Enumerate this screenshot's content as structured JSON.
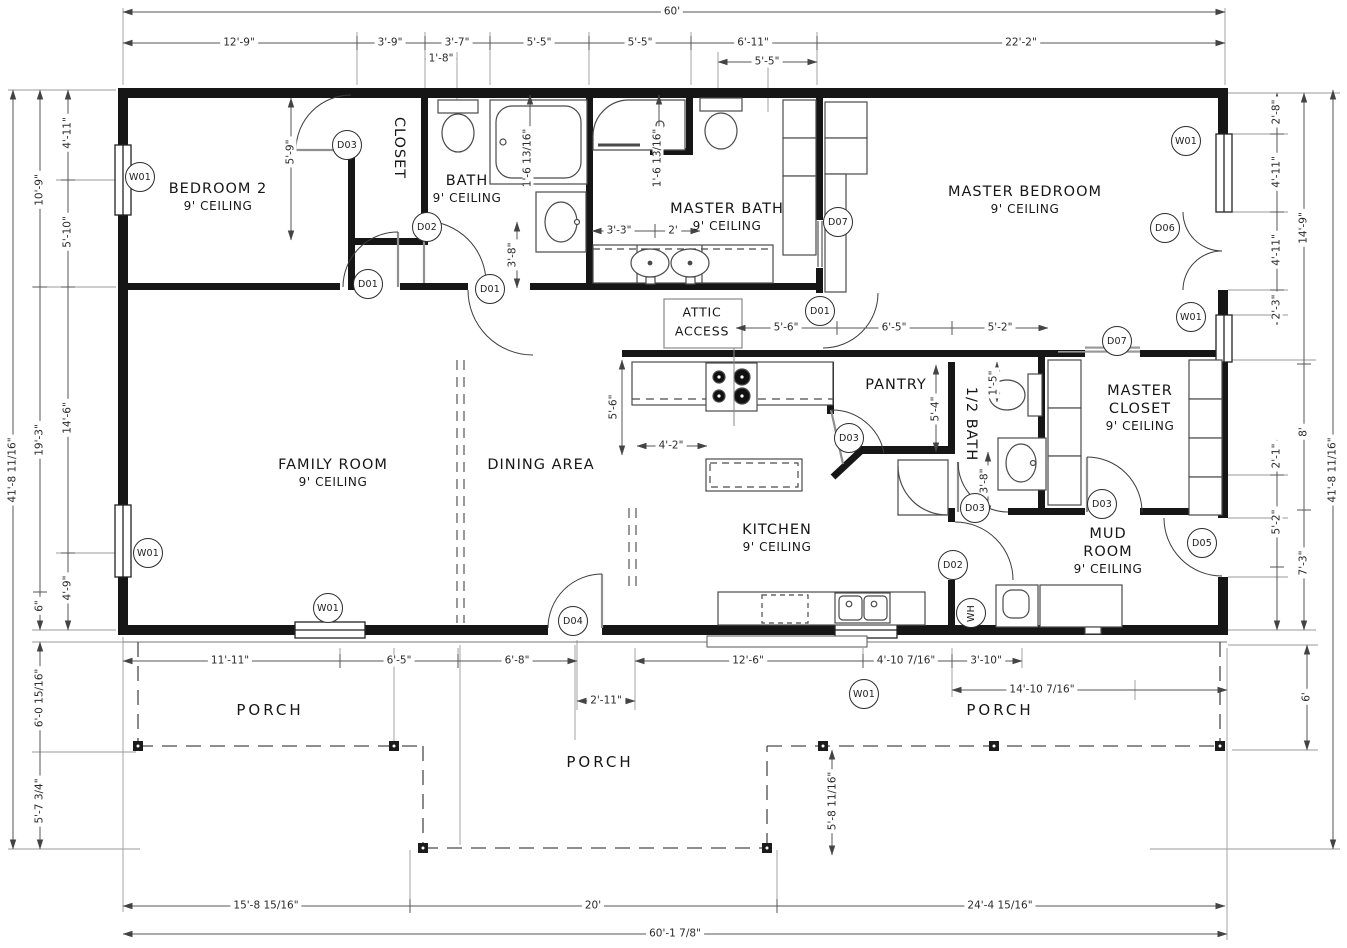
{
  "plan": {
    "rooms": [
      {
        "main": [
          "BEDROOM 2"
        ],
        "sub": "9' CEILING",
        "x": 218,
        "y": 197
      },
      {
        "main": [
          "CLOSET"
        ],
        "x": 399,
        "y": 148,
        "vert": true
      },
      {
        "main": [
          "BATH"
        ],
        "sub": "9' CEILING",
        "x": 467,
        "y": 189
      },
      {
        "main": [
          "MASTER BATH"
        ],
        "sub": "9' CEILING",
        "x": 727,
        "y": 217
      },
      {
        "main": [
          "MASTER BEDROOM"
        ],
        "sub": "9' CEILING",
        "x": 1025,
        "y": 200
      },
      {
        "main": [
          "FAMILY ROOM"
        ],
        "sub": "9' CEILING",
        "x": 333,
        "y": 473
      },
      {
        "main": [
          "DINING AREA"
        ],
        "x": 541,
        "y": 465
      },
      {
        "main": [
          "KITCHEN"
        ],
        "sub": "9' CEILING",
        "x": 777,
        "y": 538
      },
      {
        "main": [
          "PANTRY"
        ],
        "x": 896,
        "y": 385
      },
      {
        "main": [
          "1/2 BATH"
        ],
        "x": 971,
        "y": 424,
        "vert": true
      },
      {
        "main": [
          "MASTER",
          "CLOSET"
        ],
        "sub": "9' CEILING",
        "x": 1140,
        "y": 408
      },
      {
        "main": [
          "MUD",
          "ROOM"
        ],
        "sub": "9' CEILING",
        "x": 1108,
        "y": 551
      }
    ],
    "attic_note": {
      "lines": [
        "ATTIC",
        "ACCESS"
      ],
      "x": 702,
      "y": 322
    },
    "porch": {
      "label": "PORCH",
      "positions": [
        {
          "x": 270,
          "y": 710
        },
        {
          "x": 600,
          "y": 762
        },
        {
          "x": 1000,
          "y": 710
        }
      ]
    },
    "dimensions": [
      {
        "t": "60'",
        "x": 672,
        "y": 12
      },
      {
        "t": "12'-9\"",
        "x": 239,
        "y": 43
      },
      {
        "t": "3'-9\"",
        "x": 390,
        "y": 43
      },
      {
        "t": "3'-7\"",
        "x": 457,
        "y": 43
      },
      {
        "t": "5'-5\"",
        "x": 539,
        "y": 43
      },
      {
        "t": "5'-5\"",
        "x": 640,
        "y": 43
      },
      {
        "t": "6'-11\"",
        "x": 753,
        "y": 43
      },
      {
        "t": "22'-2\"",
        "x": 1021,
        "y": 43
      },
      {
        "t": "1'-8\"",
        "x": 441,
        "y": 59
      },
      {
        "t": "5'-5\"",
        "x": 767,
        "y": 62
      },
      {
        "t": "41'-8 11/16\"",
        "x": 13,
        "y": 470,
        "v": true
      },
      {
        "t": "10'-9\"",
        "x": 40,
        "y": 190,
        "v": true
      },
      {
        "t": "19'-3\"",
        "x": 40,
        "y": 440,
        "v": true
      },
      {
        "t": "6\"",
        "x": 40,
        "y": 606,
        "v": true
      },
      {
        "t": "4'-11\"",
        "x": 68,
        "y": 133,
        "v": true
      },
      {
        "t": "5'-10\"",
        "x": 68,
        "y": 232,
        "v": true
      },
      {
        "t": "14'-6\"",
        "x": 68,
        "y": 418,
        "v": true
      },
      {
        "t": "4'-9\"",
        "x": 68,
        "y": 588,
        "v": true
      },
      {
        "t": "6'-0 15/16\"",
        "x": 40,
        "y": 698,
        "v": true
      },
      {
        "t": "5'-7 3/4\"",
        "x": 40,
        "y": 801,
        "v": true
      },
      {
        "t": "2'-8\"",
        "x": 1277,
        "y": 112,
        "v": true
      },
      {
        "t": "4'-11\"",
        "x": 1277,
        "y": 172,
        "v": true
      },
      {
        "t": "4'-11\"",
        "x": 1277,
        "y": 250,
        "v": true
      },
      {
        "t": "2'-3\"",
        "x": 1277,
        "y": 307,
        "v": true
      },
      {
        "t": "2'-1\"",
        "x": 1277,
        "y": 456,
        "v": true
      },
      {
        "t": "5'-2\"",
        "x": 1277,
        "y": 522,
        "v": true
      },
      {
        "t": "14'-9\"",
        "x": 1304,
        "y": 228,
        "v": true
      },
      {
        "t": "8'",
        "x": 1304,
        "y": 432,
        "v": true
      },
      {
        "t": "7'-3\"",
        "x": 1304,
        "y": 563,
        "v": true
      },
      {
        "t": "41'-8 11/16\"",
        "x": 1333,
        "y": 470,
        "v": true
      },
      {
        "t": "6'",
        "x": 1307,
        "y": 697,
        "v": true
      },
      {
        "t": "5'-9\"",
        "x": 291,
        "y": 152,
        "v": true
      },
      {
        "t": "1'-6 13/16\"",
        "x": 528,
        "y": 158,
        "v": true
      },
      {
        "t": "1'-6 13/16\"",
        "x": 658,
        "y": 158,
        "v": true
      },
      {
        "t": "3'-3\"",
        "x": 619,
        "y": 231
      },
      {
        "t": "2'",
        "x": 673,
        "y": 231
      },
      {
        "t": "3'-8\"",
        "x": 513,
        "y": 255,
        "v": true
      },
      {
        "t": "5'-6\"",
        "x": 786,
        "y": 328
      },
      {
        "t": "6'-5\"",
        "x": 894,
        "y": 328
      },
      {
        "t": "5'-2\"",
        "x": 1000,
        "y": 328
      },
      {
        "t": "5'-6\"",
        "x": 614,
        "y": 407,
        "v": true
      },
      {
        "t": "4'-2\"",
        "x": 671,
        "y": 446
      },
      {
        "t": "5'-4\"",
        "x": 936,
        "y": 409,
        "v": true
      },
      {
        "t": "1'-5\"",
        "x": 994,
        "y": 383,
        "v": true
      },
      {
        "t": "3'-8\"",
        "x": 985,
        "y": 481,
        "v": true
      },
      {
        "t": "11'-11\"",
        "x": 230,
        "y": 661
      },
      {
        "t": "6'-5\"",
        "x": 399,
        "y": 661
      },
      {
        "t": "6'-8\"",
        "x": 517,
        "y": 661
      },
      {
        "t": "12'-6\"",
        "x": 748,
        "y": 661
      },
      {
        "t": "4'-10 7/16\"",
        "x": 906,
        "y": 661
      },
      {
        "t": "3'-10\"",
        "x": 986,
        "y": 661
      },
      {
        "t": "2'-11\"",
        "x": 606,
        "y": 701
      },
      {
        "t": "14'-10 7/16\"",
        "x": 1042,
        "y": 690
      },
      {
        "t": "5'-8 11/16\"",
        "x": 833,
        "y": 801,
        "v": true
      },
      {
        "t": "15'-8 15/16\"",
        "x": 266,
        "y": 906
      },
      {
        "t": "20'",
        "x": 593,
        "y": 906
      },
      {
        "t": "24'-4 15/16\"",
        "x": 1000,
        "y": 906
      },
      {
        "t": "60'-1 7/8\"",
        "x": 675,
        "y": 934
      }
    ],
    "tags": [
      {
        "t": "W01",
        "x": 140,
        "y": 177
      },
      {
        "t": "W01",
        "x": 148,
        "y": 553
      },
      {
        "t": "W01",
        "x": 328,
        "y": 608
      },
      {
        "t": "W01",
        "x": 864,
        "y": 694
      },
      {
        "t": "W01",
        "x": 1186,
        "y": 141
      },
      {
        "t": "W01",
        "x": 1191,
        "y": 317
      },
      {
        "t": "D01",
        "x": 368,
        "y": 284
      },
      {
        "t": "D01",
        "x": 490,
        "y": 289
      },
      {
        "t": "D01",
        "x": 820,
        "y": 311
      },
      {
        "t": "D02",
        "x": 427,
        "y": 227
      },
      {
        "t": "D02",
        "x": 953,
        "y": 565
      },
      {
        "t": "D03",
        "x": 347,
        "y": 145
      },
      {
        "t": "D03",
        "x": 849,
        "y": 438
      },
      {
        "t": "D03",
        "x": 975,
        "y": 508
      },
      {
        "t": "D03",
        "x": 1102,
        "y": 504
      },
      {
        "t": "D04",
        "x": 573,
        "y": 621
      },
      {
        "t": "D05",
        "x": 1202,
        "y": 543
      },
      {
        "t": "D06",
        "x": 1165,
        "y": 228
      },
      {
        "t": "D07",
        "x": 838,
        "y": 222
      },
      {
        "t": "D07",
        "x": 1117,
        "y": 341
      },
      {
        "t": "WH",
        "x": 971,
        "y": 613,
        "rot": true
      }
    ]
  }
}
